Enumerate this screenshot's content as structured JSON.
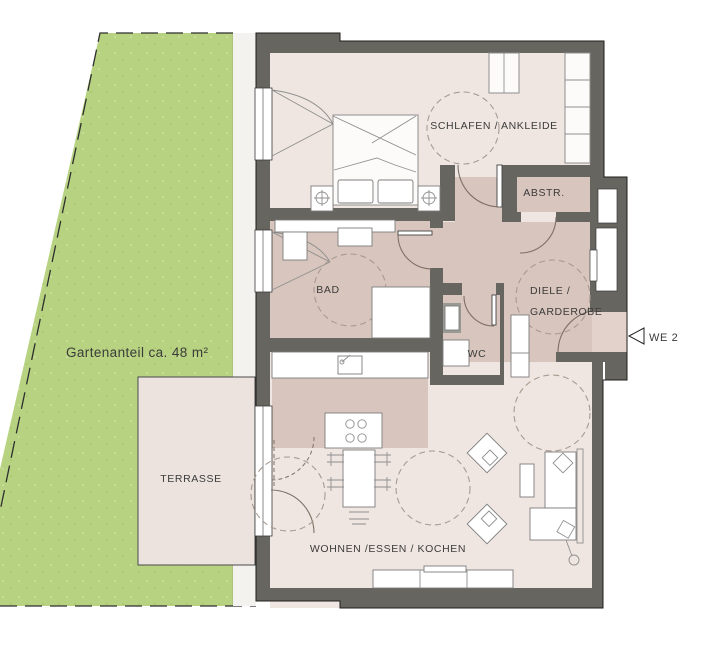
{
  "garden": {
    "label": "Gartenanteil ca. 48 m²"
  },
  "terrace": {
    "label": "TERRASSE"
  },
  "rooms": {
    "bedroom": {
      "label": "SCHLAFEN / ANKLEIDE"
    },
    "storage": {
      "label": "ABSTR."
    },
    "bathroom": {
      "label": "BAD"
    },
    "wc": {
      "label": "WC"
    },
    "hallway": {
      "label_line1": "DIELE /",
      "label_line2": "GARDEROBE"
    },
    "living": {
      "label": "WOHNEN /ESSEN / KOCHEN"
    }
  },
  "unit": {
    "label": "WE 2"
  },
  "colors": {
    "wall": "#67655f",
    "floor_light": "#efe6e1",
    "floor_accent": "#d8c5bd",
    "garden_green": "#b7d381",
    "terrace_floor": "#ece3de",
    "outline": "#1d1d1b",
    "furniture_line": "#8f8f8f",
    "door_swing": "#7d6f66",
    "turning_circle": "#a89a90",
    "text": "#3b3b3b"
  }
}
